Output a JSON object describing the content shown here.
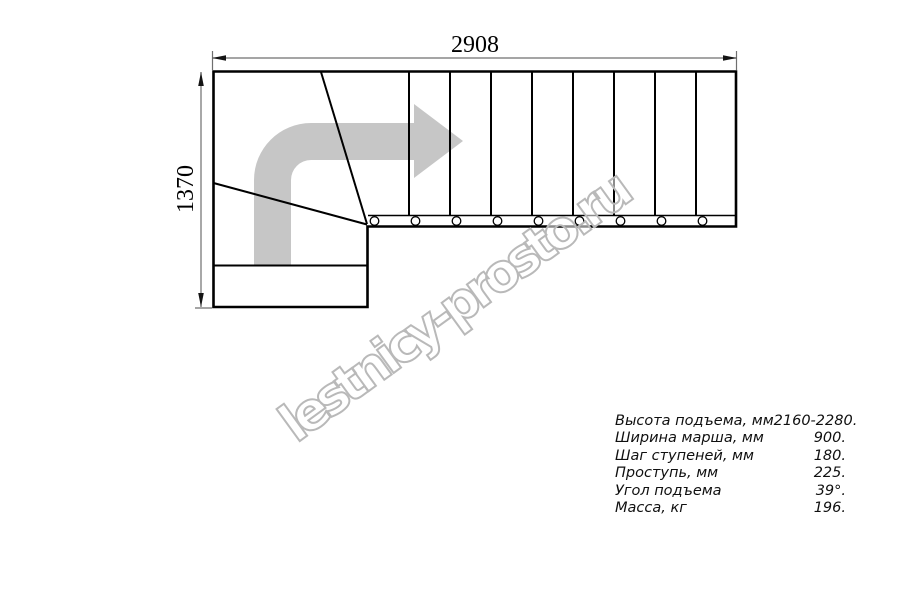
{
  "diagram": {
    "top_dimension": "2908",
    "left_dimension": "1370",
    "straight_treads": 9,
    "winder_treads": 3,
    "direction_arrow": "curved-right-arrow"
  },
  "watermark": {
    "text": "lestnicy-prosto.ru"
  },
  "specs": {
    "rows": [
      {
        "label": "Высота подъема, мм",
        "value": "2160-2280."
      },
      {
        "label": "Ширина марша, мм",
        "value": "900."
      },
      {
        "label": "Шаг ступеней, мм",
        "value": "180."
      },
      {
        "label": "Проступь, мм",
        "value": "225."
      },
      {
        "label": "Угол подъема",
        "value": "39°."
      },
      {
        "label": "Масса, кг",
        "value": "196."
      }
    ]
  },
  "colors": {
    "background": "#ffffff",
    "line": "#000000",
    "dimension": "#6f6f6f",
    "arrow": "#c6c6c6",
    "watermark": "#b9b9b9"
  }
}
